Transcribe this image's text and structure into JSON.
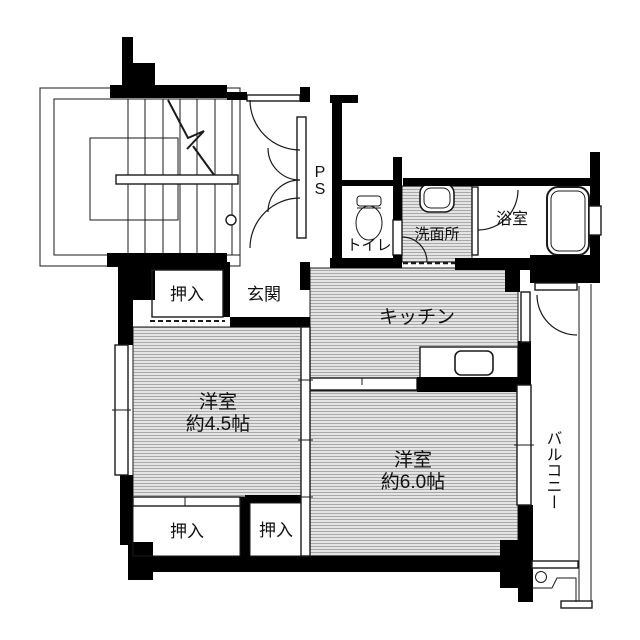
{
  "floorplan": {
    "labels": {
      "ps": "PS",
      "toilet": "トイレ",
      "washroom": "洗面所",
      "bathroom": "浴室",
      "kitchen": "キッチン",
      "entrance": "玄関",
      "closet_upper": "押入",
      "closet_lower_left": "押入",
      "closet_lower_right": "押入",
      "room45_name": "洋室",
      "room45_size": "約4.5帖",
      "room60_name": "洋室",
      "room60_size": "約6.0帖",
      "balcony": "バルコニー"
    },
    "colors": {
      "walls": "#000000",
      "room_fill": "#e4e4e4",
      "hatch_line": "#a9a9a9",
      "background": "#ffffff",
      "text": "#111111"
    }
  }
}
